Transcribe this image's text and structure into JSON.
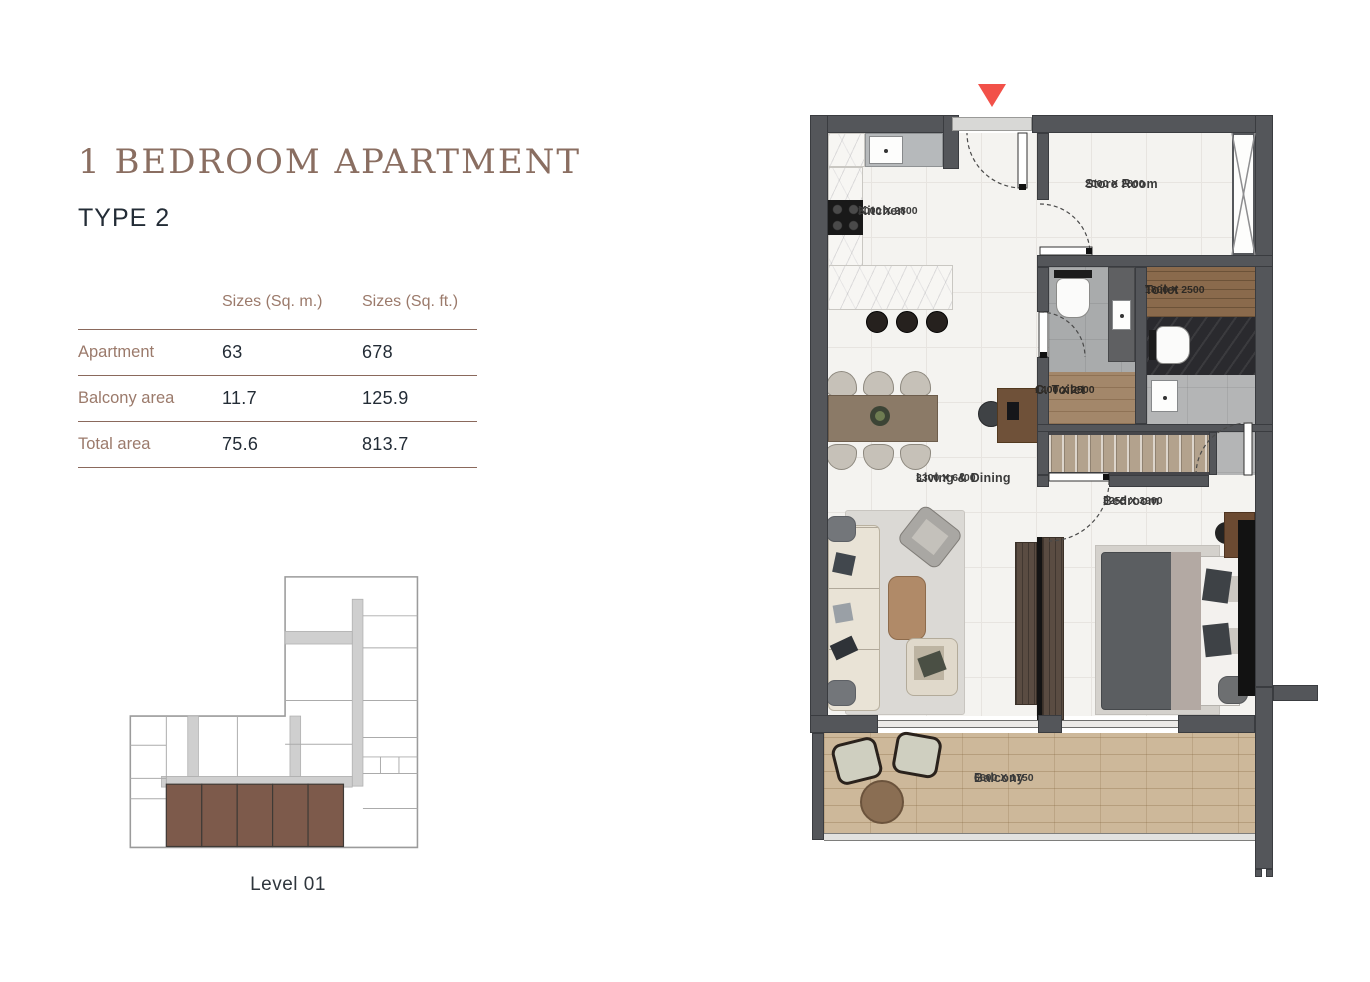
{
  "header": {
    "title": "1 BEDROOM APARTMENT",
    "subtitle": "TYPE 2"
  },
  "table": {
    "columns": [
      "Sizes (Sq. m.)",
      "Sizes (Sq. ft.)"
    ],
    "rows": [
      {
        "label": "Apartment",
        "sqm": "63",
        "sqft": "678"
      },
      {
        "label": "Balcony area",
        "sqm": "11.7",
        "sqft": "125.9"
      },
      {
        "label": "Total area",
        "sqm": "75.6",
        "sqft": "813.7"
      }
    ]
  },
  "level_plan": {
    "caption": "Level 01",
    "highlight_color": "#7d5a4b"
  },
  "floor_plan": {
    "entry_marker_color": "#f25149",
    "rooms": [
      {
        "name": "Kitchen",
        "dim": "2000 X 2800"
      },
      {
        "name": "Store Room",
        "dim": "2000 X 2800"
      },
      {
        "name": "Toilet",
        "dim": "1800 X 2500"
      },
      {
        "name": "C. Toilet",
        "dim": "1400 X 2500"
      },
      {
        "name": "Living & Dining",
        "dim": "3300 X 6400"
      },
      {
        "name": "Bedroom",
        "dim": "3255 X 3900"
      },
      {
        "name": "Balcony",
        "dim": "6600 X 1750"
      }
    ]
  },
  "colors": {
    "title": "#8a6e61",
    "label_brown": "#9b7a6b",
    "accent_line": "#8a695c",
    "dark_text": "#232c36",
    "wall": "#54565a"
  }
}
